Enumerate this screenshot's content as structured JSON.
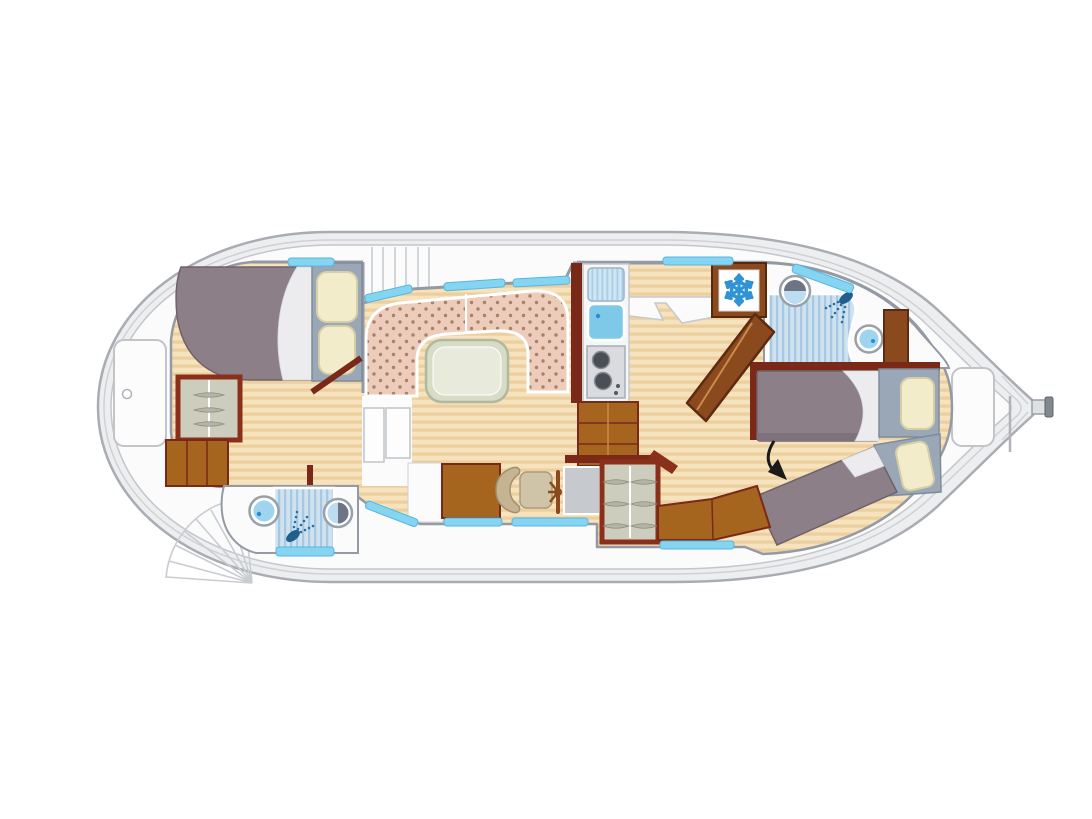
{
  "diagram": {
    "type": "houseboat-floor-plan",
    "orientation": "bow-left-stern-right",
    "icons": {
      "fridge": "snowflake-icon",
      "bow_shower": "shower-head-icon",
      "aft_shower": "shower-head-icon",
      "bed_pointer": "curved-arrow-icon"
    },
    "rooms": {
      "bow_cabin": "double-bed-cabin",
      "bow_bathroom": "shower-sink-toilet",
      "salon": "u-shaped-dinette-with-table",
      "galley": "sink-drainer-two-burner-stove",
      "helm": "seat-wheel-console",
      "aft_bathroom": "shower-sink-toilet-fridge",
      "aft_cabin": "two-single-beds"
    }
  },
  "colors": {
    "hull-band": "#EDEEF0",
    "hull-stroke": "#A9ACB2",
    "deck": "#FBFBFC",
    "deck-line": "#D2D5D9",
    "wall": "#939AA4",
    "floor-base": "#F6E2BC",
    "floor-stripe": "#ECCF9E",
    "wood": "#A5651F",
    "wood-dark": "#7A2818",
    "frame-red": "#8A2F1A",
    "cabinet-interior": "#CDCDBD",
    "mattress": "#8D7F88",
    "sheet-white": "#ECECEE",
    "headboard": "#9AA7B6",
    "pillow": "#F2ECCA",
    "dinette": "#EECCBC",
    "dinette-dot": "#AA8166",
    "table-outer": "#D7DCC6",
    "table-inner": "#E8EBDC",
    "window-blue": "#85D4F2",
    "water-blue": "#9FD4EF",
    "shower-blue": "#CFE2F0",
    "shower-stripe": "#A6C8E2",
    "snowflake-blue": "#2F93D6",
    "console-gray": "#C6C9CE",
    "seat-beige": "#C6B392",
    "arrow-black": "#1A1A1A"
  }
}
